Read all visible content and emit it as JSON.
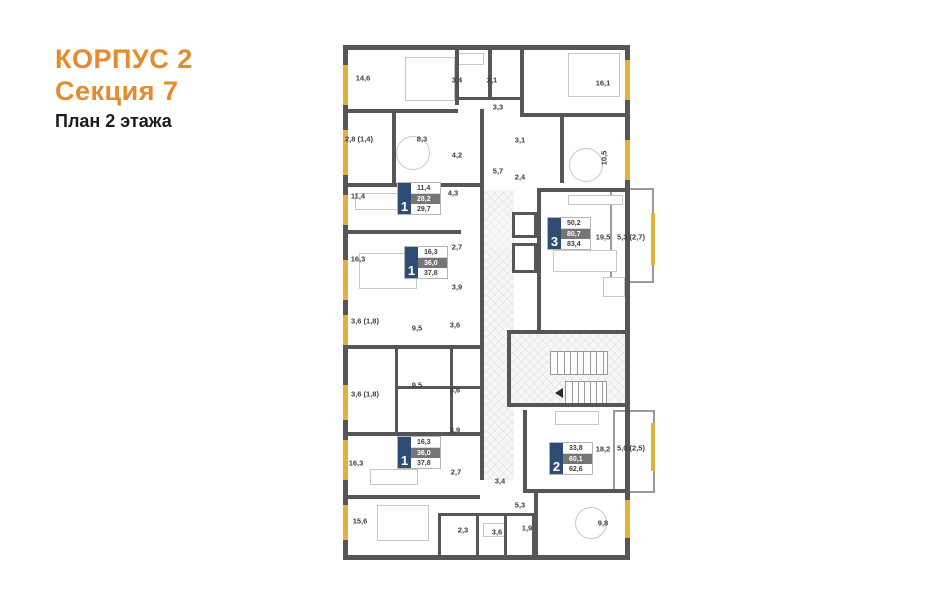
{
  "title": {
    "building": "КОРПУС 2",
    "section": "Секция 7",
    "floor": "План 2 этажа"
  },
  "colors": {
    "accent": "#E68A2E",
    "wall": "#565656",
    "window": "#E3B23A",
    "badge_navy": "#2F4D74",
    "badge_gray": "#757575"
  },
  "plan": {
    "room_labels": [
      {
        "label": "14,6",
        "x": 20,
        "y": 33
      },
      {
        "label": "3,4",
        "x": 114,
        "y": 35
      },
      {
        "label": "2,1",
        "x": 149,
        "y": 35
      },
      {
        "label": "16,1",
        "x": 260,
        "y": 38
      },
      {
        "label": "3,3",
        "x": 155,
        "y": 62
      },
      {
        "label": "2,8 (1,4)",
        "x": 16,
        "y": 94
      },
      {
        "label": "8,3",
        "x": 79,
        "y": 94
      },
      {
        "label": "3,1",
        "x": 177,
        "y": 95
      },
      {
        "label": "4,2",
        "x": 114,
        "y": 110
      },
      {
        "label": "10,5",
        "x": 261,
        "y": 113,
        "vertical": true
      },
      {
        "label": "5,7",
        "x": 155,
        "y": 126
      },
      {
        "label": "2,4",
        "x": 177,
        "y": 132
      },
      {
        "label": "11,4",
        "x": 15,
        "y": 151
      },
      {
        "label": "4,3",
        "x": 110,
        "y": 148
      },
      {
        "label": "19,5",
        "x": 260,
        "y": 192
      },
      {
        "label": "5,3 (2,7)",
        "x": 288,
        "y": 192
      },
      {
        "label": "2,7",
        "x": 114,
        "y": 202
      },
      {
        "label": "16,3",
        "x": 15,
        "y": 214
      },
      {
        "label": "3,9",
        "x": 114,
        "y": 242
      },
      {
        "label": "3,6 (1,8)",
        "x": 22,
        "y": 276
      },
      {
        "label": "9,5",
        "x": 74,
        "y": 283
      },
      {
        "label": "3,6",
        "x": 112,
        "y": 280
      },
      {
        "label": "9,5",
        "x": 74,
        "y": 340
      },
      {
        "label": "3,6",
        "x": 112,
        "y": 345
      },
      {
        "label": "3,6 (1,8)",
        "x": 22,
        "y": 349
      },
      {
        "label": "3,9",
        "x": 112,
        "y": 385
      },
      {
        "label": "16,3",
        "x": 13,
        "y": 418
      },
      {
        "label": "2,7",
        "x": 113,
        "y": 427
      },
      {
        "label": "3,4",
        "x": 157,
        "y": 436
      },
      {
        "label": "18,2",
        "x": 260,
        "y": 404
      },
      {
        "label": "5,0 (2,5)",
        "x": 288,
        "y": 403
      },
      {
        "label": "5,3",
        "x": 177,
        "y": 460
      },
      {
        "label": "15,6",
        "x": 17,
        "y": 476
      },
      {
        "label": "2,3",
        "x": 120,
        "y": 485
      },
      {
        "label": "3,6",
        "x": 154,
        "y": 487
      },
      {
        "label": "1,9",
        "x": 184,
        "y": 483
      },
      {
        "label": "9,8",
        "x": 260,
        "y": 478
      }
    ],
    "apartments": [
      {
        "number": "1",
        "values": [
          "11,4",
          "28,2",
          "29,7"
        ],
        "x": 55,
        "y": 138
      },
      {
        "number": "1",
        "values": [
          "16,3",
          "36,0",
          "37,8"
        ],
        "x": 62,
        "y": 202
      },
      {
        "number": "3",
        "values": [
          "50,2",
          "80,7",
          "83,4"
        ],
        "x": 205,
        "y": 173
      },
      {
        "number": "1",
        "values": [
          "16,3",
          "36,0",
          "37,8"
        ],
        "x": 55,
        "y": 392
      },
      {
        "number": "2",
        "values": [
          "33,8",
          "60,1",
          "62,6"
        ],
        "x": 207,
        "y": 398
      }
    ]
  }
}
